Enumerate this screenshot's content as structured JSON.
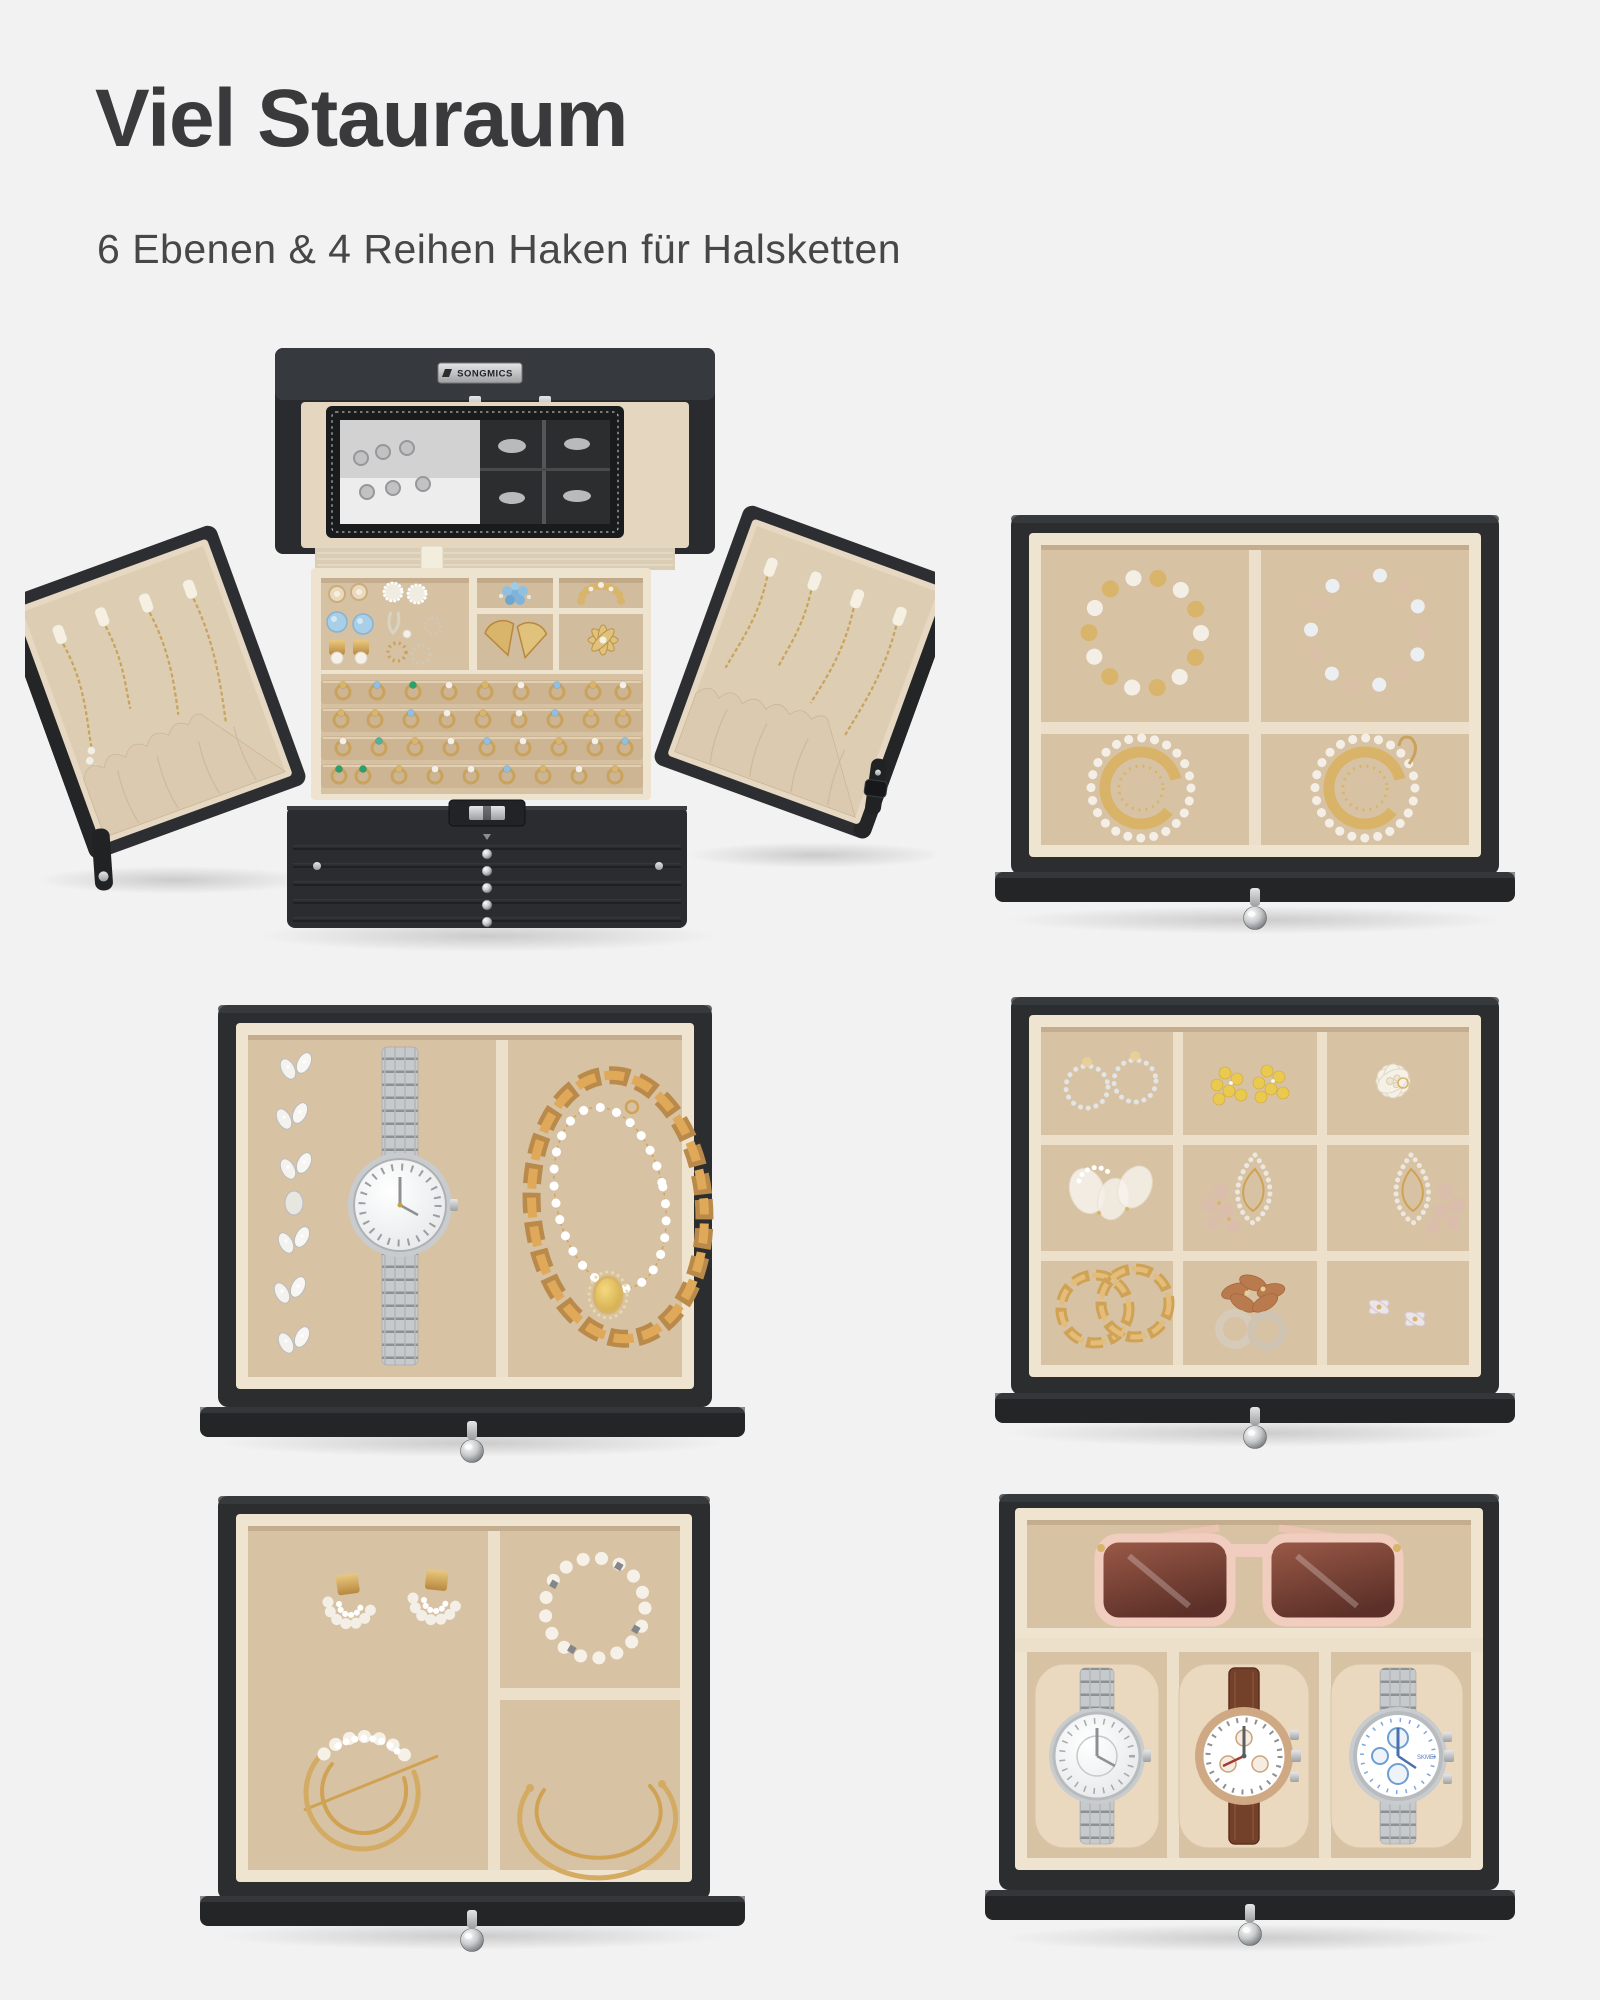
{
  "page": {
    "title": "Viel Stauraum",
    "subtitle": "6 Ebenen & 4 Reihen Haken für Halsketten",
    "background_color": "#f2f2f2",
    "title_color": "#3a3a3c",
    "subtitle_color": "#474747"
  },
  "brand": {
    "logo_text": "SONGMICS"
  },
  "palette": {
    "box_black": "#2b2d2f",
    "velvet": "#d7c1a3",
    "cream": "#eee3cf",
    "gold": "#c9a35c",
    "pearl": "#f4efe6",
    "silver": "#c6c9cc",
    "blue_gem": "#8fc0e2",
    "green_gem": "#2aa06c",
    "yellow": "#e9c94e",
    "strap_brown": "#73402a",
    "sunglasses_frame": "#f0cdbe",
    "lens_brown": "#7d4638",
    "knob_silver": "#b9bcbf"
  },
  "panels": {
    "open_box": {
      "name": "jewelry-box-open",
      "features": [
        "mirror-lid",
        "songmics-logo-plate",
        "stud-earring-tray",
        "brooch-compartments",
        "four-ring-rows",
        "left-necklace-door",
        "right-necklace-door",
        "six-drawer-front-with-lock"
      ]
    },
    "drawer_bracelets": {
      "name": "drawer-4-compartments",
      "items": [
        "white-gold-bead-bracelet",
        "beige-crystal-bead-bracelet",
        "gold-crescent-fringe-earring",
        "gold-crescent-fringe-earring"
      ]
    },
    "drawer_watch": {
      "name": "drawer-2-compartments",
      "items": [
        "crystal-leaf-bracelet",
        "silver-link-watch",
        "gold-curb-chain-necklace",
        "pearl-chain-with-amber-pendant"
      ]
    },
    "drawer_grid": {
      "name": "drawer-9-compartments",
      "items": [
        "crystal-hoop-stud-earrings",
        "yellow-flower-earrings",
        "white-pearl-flower-brooch",
        "white-tulle-pearl-earrings",
        "crystal-teardrop-earrings-pink-beads",
        "crystal-teardrop-earrings-pink-beads",
        "gold-chain-hoop-earrings",
        "brown-flower-ring-earrings",
        "crystal-bow-earrings"
      ]
    },
    "drawer_hair": {
      "name": "drawer-3-compartments",
      "items": [
        "pearl-fan-stud-earrings",
        "gold-crescent-pearl-hair-pin",
        "pearl-bead-bracelet",
        "gold-double-cuff-bangle"
      ]
    },
    "drawer_watches": {
      "name": "drawer-watch-tray",
      "watch_brand_text": "SKMEI",
      "items": [
        "rose-frame-sunglasses",
        "silver-dial-watch",
        "brown-leather-chronograph",
        "steel-blue-chronograph"
      ]
    }
  }
}
